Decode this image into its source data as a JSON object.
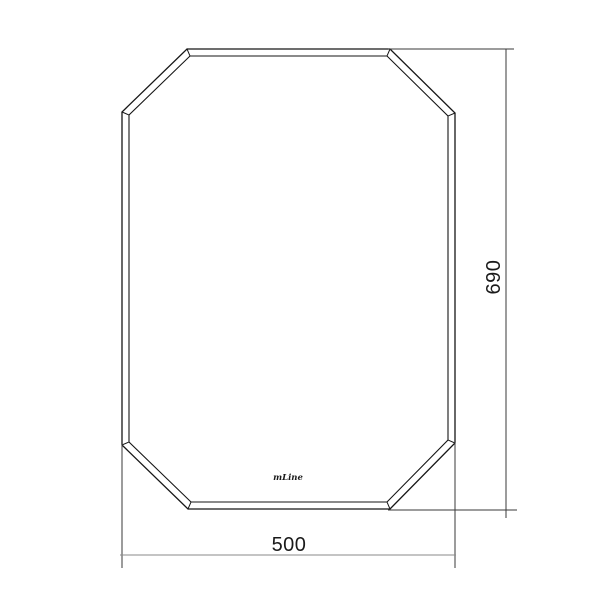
{
  "drawing": {
    "logo": "mLine",
    "dimensions": {
      "width_label": "500",
      "height_label": "690"
    },
    "colors": {
      "background": "#ffffff",
      "outline": "#161616",
      "annotation_lines": "#3a3a3a",
      "width_dim_line": "#8a8a8a",
      "text": "#1a1a1a"
    }
  }
}
